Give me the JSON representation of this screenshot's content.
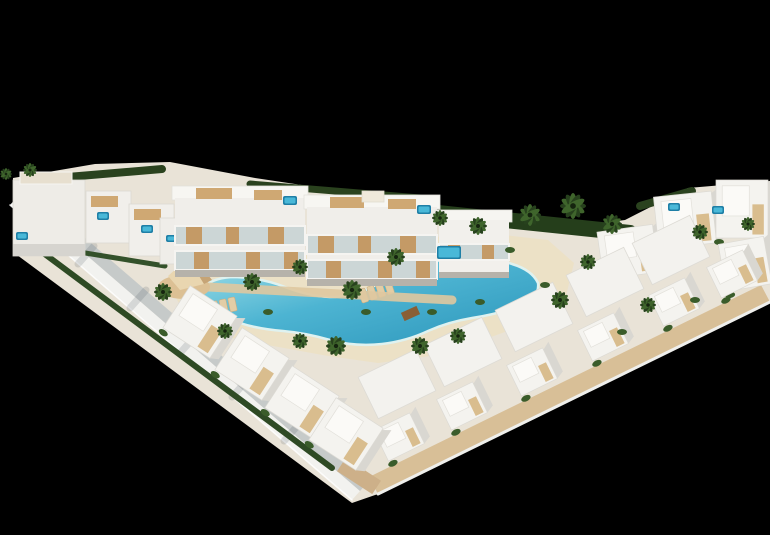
{
  "canvas": {
    "w": 770,
    "h": 535,
    "bg": "#000000"
  },
  "palette": {
    "background": "#000000",
    "building_white": "#f4f3ef",
    "building_shadow": "#c6cac9",
    "pool_light": "#9fdfe8",
    "pool_mid": "#4db4d2",
    "pool_deep": "#2b95ba",
    "sand": "#ece1c6",
    "wood": "#c49a66",
    "deck_wood": "#d8bf97",
    "hedge_green": "#253e1b",
    "palm_green": "#3f652c"
  },
  "shapes": [
    {
      "t": "poly",
      "n": "site-ground",
      "p": "13,178 95,164 170,162 255,178 335,190 425,202 490,217 565,228 625,220 688,188 770,181 770,302 378,494 352,503 13,252",
      "f": "#e9e3d7"
    },
    {
      "t": "poly",
      "n": "perimeter-wall-outer",
      "p": "10,205 352,500 360,491 18,196",
      "f": "#f2f2ef"
    },
    {
      "t": "poly",
      "n": "perimeter-wall-inner",
      "p": "18,196 360,491 368,482 26,187",
      "f": "#c6cac9"
    },
    {
      "t": "line",
      "n": "wall-edge-highlight",
      "x1": 10,
      "y1": 205,
      "x2": 352,
      "y2": 500,
      "f": "#ffffff",
      "wd": 1.5,
      "o": 0.85
    },
    {
      "t": "line",
      "n": "wall-shadow-streak",
      "x1": 78,
      "y1": 264,
      "x2": 94,
      "y2": 246,
      "f": "rgba(60,72,84,0.16)",
      "wd": 7
    },
    {
      "t": "line",
      "n": "wall-shadow-streak",
      "x1": 130,
      "y1": 308,
      "x2": 146,
      "y2": 290,
      "f": "rgba(60,72,84,0.16)",
      "wd": 7
    },
    {
      "t": "line",
      "n": "wall-shadow-streak",
      "x1": 181,
      "y1": 352,
      "x2": 197,
      "y2": 334,
      "f": "rgba(60,72,84,0.16)",
      "wd": 7
    },
    {
      "t": "line",
      "n": "wall-shadow-streak",
      "x1": 232,
      "y1": 397,
      "x2": 248,
      "y2": 379,
      "f": "rgba(60,72,84,0.16)",
      "wd": 7
    },
    {
      "t": "line",
      "n": "wall-shadow-streak",
      "x1": 284,
      "y1": 441,
      "x2": 300,
      "y2": 423,
      "f": "rgba(60,72,84,0.16)",
      "wd": 7
    },
    {
      "t": "poly",
      "n": "boardwalk-deck",
      "p": "770,302 378,494 369,477 761,285",
      "f": "#d8bf97"
    },
    {
      "t": "line",
      "n": "deck-edge-highlight",
      "x1": 770,
      "y1": 302,
      "x2": 378,
      "y2": 494,
      "f": "#efefec",
      "wd": 3
    },
    {
      "t": "poly",
      "n": "beach-sand",
      "p": "175,296 205,267 255,257 315,251 375,244 435,237 495,234 548,240 574,263 566,296 530,323 480,341 430,356 378,363 328,356 273,346 223,336 187,318",
      "f": "#ece1c6"
    },
    {
      "t": "line",
      "n": "hedge",
      "x1": 32,
      "y1": 180,
      "x2": 162,
      "y2": 169,
      "f": "#2a421e",
      "wd": 8
    },
    {
      "t": "line",
      "n": "hedge",
      "x1": 250,
      "y1": 184,
      "x2": 420,
      "y2": 198,
      "f": "#2a421e",
      "wd": 7
    },
    {
      "t": "line",
      "n": "hedge",
      "x1": 428,
      "y1": 212,
      "x2": 630,
      "y2": 233,
      "f": "#253e1b",
      "wd": 16
    },
    {
      "t": "line",
      "n": "hedge",
      "x1": 640,
      "y1": 206,
      "x2": 692,
      "y2": 191,
      "f": "#2a421e",
      "wd": 8
    },
    {
      "t": "line",
      "n": "hedge",
      "x1": 42,
      "y1": 252,
      "x2": 332,
      "y2": 468,
      "f": "#2e4a24",
      "wd": 6
    },
    {
      "t": "line",
      "n": "hedge",
      "x1": 30,
      "y1": 244,
      "x2": 165,
      "y2": 266,
      "f": "#33512a",
      "wd": 5
    },
    {
      "t": "path",
      "n": "lagoon-pool",
      "d": "M203,287 Q215,277 235,277 Q262,278 285,287 Q308,296 330,297 Q352,297 372,287 Q392,276 412,268 Q435,259 462,258 Q492,257 512,264 Q532,270 538,283 Q540,298 520,306 Q498,314 472,318 Q448,322 428,331 Q407,341 382,344 Q355,347 330,340 Q306,333 283,331 Q258,329 240,323 Q218,316 207,303 Q197,292 203,287 Z",
      "f": "url(#gPool)",
      "st": "#dff2f0",
      "sw": 2.5
    },
    {
      "t": "rect",
      "n": "wood-bridge",
      "x": 402,
      "y": 309,
      "w": 17,
      "h": 9,
      "r": -24,
      "f": "#8a5f35"
    },
    {
      "t": "lounger",
      "n": "sun-loungers",
      "x": 358,
      "y": 290,
      "r": -18,
      "c": 4
    },
    {
      "t": "lounger",
      "n": "sun-loungers",
      "x": 210,
      "y": 302,
      "r": -12,
      "c": 3
    },
    {
      "t": "line",
      "n": "promenade-path",
      "x1": 190,
      "y1": 286,
      "x2": 452,
      "y2": 300,
      "f": "#dfc8a0",
      "wd": 9,
      "o": 0.9
    },
    {
      "t": "ellipse",
      "n": "sand-dune",
      "cx": 184,
      "cy": 287,
      "rx": 26,
      "ry": 12,
      "f": "#dcc094"
    },
    {
      "t": "poly",
      "n": "shade-sail",
      "p": "168,276 188,258 204,284 180,290",
      "f": "#e9d6b0"
    },
    {
      "t": "poly",
      "n": "shade-sail",
      "p": "188,258 204,284 212,280 198,262",
      "f": "#c6a476"
    },
    {
      "t": "rect",
      "n": "townhouse-block",
      "x": 13,
      "y": 180,
      "w": 72,
      "h": 76,
      "f": "#eeece7",
      "st": "#dbd9d3",
      "sw": 0.8
    },
    {
      "t": "rect",
      "n": "townhouse-base-shadow",
      "x": 13,
      "y": 244,
      "w": 72,
      "h": 12,
      "f": "#d6d4cf"
    },
    {
      "t": "rect",
      "n": "roof-terrace",
      "x": 20,
      "y": 172,
      "w": 52,
      "h": 12,
      "f": "#e7dfcf",
      "st": "#f6f5f1",
      "sw": 1
    },
    {
      "t": "rect",
      "n": "townhouse",
      "x": 86,
      "y": 191,
      "w": 45,
      "h": 52,
      "f": "#f1efeb",
      "st": "#dbd9d3",
      "sw": 0.8
    },
    {
      "t": "rect",
      "n": "roof-deck-wood",
      "x": 91,
      "y": 196,
      "w": 27,
      "h": 11,
      "f": "#cfa873"
    },
    {
      "t": "rect",
      "n": "townhouse",
      "x": 129,
      "y": 204,
      "w": 45,
      "h": 52,
      "f": "#f1efeb",
      "st": "#dbd9d3",
      "sw": 0.8
    },
    {
      "t": "rect",
      "n": "roof-deck-wood",
      "x": 134,
      "y": 209,
      "w": 27,
      "h": 11,
      "f": "#cfa873"
    },
    {
      "t": "rect",
      "n": "townhouse",
      "x": 160,
      "y": 218,
      "w": 34,
      "h": 46,
      "f": "#efede9",
      "st": "#dbd9d3",
      "sw": 0.8
    },
    {
      "t": "spa",
      "n": "roof-spa",
      "x": 97,
      "y": 212,
      "w": 12,
      "h": 8
    },
    {
      "t": "spa",
      "n": "roof-spa",
      "x": 141,
      "y": 225,
      "w": 12,
      "h": 8
    },
    {
      "t": "spa",
      "n": "roof-spa",
      "x": 166,
      "y": 235,
      "w": 10,
      "h": 7
    },
    {
      "t": "spa",
      "n": "garden-spa",
      "x": 16,
      "y": 232,
      "w": 12,
      "h": 8
    },
    {
      "t": "rect",
      "n": "apartment-roof",
      "x": 172,
      "y": 186,
      "w": 136,
      "h": 14,
      "f": "#f7f6f2",
      "st": "#e3e1db",
      "sw": 0.8
    },
    {
      "t": "rect",
      "n": "apartment-body",
      "x": 175,
      "y": 198,
      "w": 130,
      "h": 74,
      "f": "#f0eeea"
    },
    {
      "t": "rect",
      "n": "balcony-band",
      "x": 175,
      "y": 226,
      "w": 130,
      "h": 19,
      "f": "#ccd6d6"
    },
    {
      "t": "rect",
      "n": "wood-panel",
      "x": 186,
      "y": 226,
      "w": 16,
      "h": 19,
      "f": "#c49a66"
    },
    {
      "t": "rect",
      "n": "wood-panel",
      "x": 226,
      "y": 226,
      "w": 13,
      "h": 19,
      "f": "#c49a66"
    },
    {
      "t": "rect",
      "n": "wood-panel",
      "x": 268,
      "y": 226,
      "w": 16,
      "h": 19,
      "f": "#c49a66"
    },
    {
      "t": "rect",
      "n": "balcony-frame",
      "x": 175,
      "y": 226,
      "w": 130,
      "h": 19,
      "f": "none",
      "st": "#f5f4f1",
      "sw": 2
    },
    {
      "t": "rect",
      "n": "balcony-band",
      "x": 175,
      "y": 251,
      "w": 130,
      "h": 19,
      "f": "#ccd6d6"
    },
    {
      "t": "rect",
      "n": "wood-panel",
      "x": 194,
      "y": 251,
      "w": 15,
      "h": 19,
      "f": "#c49a66"
    },
    {
      "t": "rect",
      "n": "wood-panel",
      "x": 246,
      "y": 251,
      "w": 14,
      "h": 19,
      "f": "#c49a66"
    },
    {
      "t": "rect",
      "n": "wood-panel",
      "x": 284,
      "y": 251,
      "w": 14,
      "h": 19,
      "f": "#c49a66"
    },
    {
      "t": "rect",
      "n": "balcony-frame",
      "x": 175,
      "y": 251,
      "w": 130,
      "h": 19,
      "f": "none",
      "st": "#f5f4f1",
      "sw": 2
    },
    {
      "t": "rect",
      "n": "apartment-base-shadow",
      "x": 175,
      "y": 270,
      "w": 130,
      "h": 7,
      "f": "#b6b2aa"
    },
    {
      "t": "rect",
      "n": "roof-deck-wood",
      "x": 196,
      "y": 188,
      "w": 36,
      "h": 11,
      "f": "#cfa873"
    },
    {
      "t": "rect",
      "n": "roof-deck-wood",
      "x": 254,
      "y": 190,
      "w": 28,
      "h": 10,
      "f": "#cfa873"
    },
    {
      "t": "spa",
      "n": "roof-spa",
      "x": 283,
      "y": 196,
      "w": 14,
      "h": 9
    },
    {
      "t": "rect",
      "n": "apartment-roof",
      "x": 304,
      "y": 195,
      "w": 136,
      "h": 14,
      "f": "#f7f6f2",
      "st": "#e3e1db",
      "sw": 0.8
    },
    {
      "t": "rect",
      "n": "apartment-body",
      "x": 307,
      "y": 207,
      "w": 130,
      "h": 74,
      "f": "#f0eeea"
    },
    {
      "t": "rect",
      "n": "balcony-band",
      "x": 307,
      "y": 235,
      "w": 130,
      "h": 19,
      "f": "#ccd6d6"
    },
    {
      "t": "rect",
      "n": "wood-panel",
      "x": 318,
      "y": 235,
      "w": 16,
      "h": 19,
      "f": "#c49a66"
    },
    {
      "t": "rect",
      "n": "wood-panel",
      "x": 358,
      "y": 235,
      "w": 13,
      "h": 19,
      "f": "#c49a66"
    },
    {
      "t": "rect",
      "n": "wood-panel",
      "x": 400,
      "y": 235,
      "w": 16,
      "h": 19,
      "f": "#c49a66"
    },
    {
      "t": "rect",
      "n": "balcony-frame",
      "x": 307,
      "y": 235,
      "w": 130,
      "h": 19,
      "f": "none",
      "st": "#f5f4f1",
      "sw": 2
    },
    {
      "t": "rect",
      "n": "balcony-band",
      "x": 307,
      "y": 260,
      "w": 130,
      "h": 19,
      "f": "#ccd6d6"
    },
    {
      "t": "rect",
      "n": "wood-panel",
      "x": 326,
      "y": 260,
      "w": 15,
      "h": 19,
      "f": "#c49a66"
    },
    {
      "t": "rect",
      "n": "wood-panel",
      "x": 378,
      "y": 260,
      "w": 14,
      "h": 19,
      "f": "#c49a66"
    },
    {
      "t": "rect",
      "n": "wood-panel",
      "x": 416,
      "y": 260,
      "w": 14,
      "h": 19,
      "f": "#c49a66"
    },
    {
      "t": "rect",
      "n": "balcony-frame",
      "x": 307,
      "y": 260,
      "w": 130,
      "h": 19,
      "f": "none",
      "st": "#f5f4f1",
      "sw": 2
    },
    {
      "t": "rect",
      "n": "apartment-base-shadow",
      "x": 307,
      "y": 279,
      "w": 130,
      "h": 7,
      "f": "#b6b2aa"
    },
    {
      "t": "rect",
      "n": "roof-deck-wood",
      "x": 330,
      "y": 197,
      "w": 34,
      "h": 11,
      "f": "#cfa873"
    },
    {
      "t": "rect",
      "n": "roof-deck-wood",
      "x": 388,
      "y": 199,
      "w": 28,
      "h": 10,
      "f": "#cfa873"
    },
    {
      "t": "rect",
      "n": "stair-bulkhead",
      "x": 362,
      "y": 191,
      "w": 22,
      "h": 11,
      "f": "#efe9db",
      "st": "#e0dcd0",
      "sw": 0.8
    },
    {
      "t": "spa",
      "n": "roof-spa",
      "x": 417,
      "y": 205,
      "w": 14,
      "h": 9
    },
    {
      "t": "rect",
      "n": "apartment-roof",
      "x": 436,
      "y": 210,
      "w": 76,
      "h": 12,
      "f": "#f6f5f1",
      "st": "#e3e1db",
      "sw": 0.8
    },
    {
      "t": "rect",
      "n": "apartment-body",
      "x": 439,
      "y": 220,
      "w": 70,
      "h": 56,
      "f": "#f2f0ec"
    },
    {
      "t": "rect",
      "n": "balcony-band",
      "x": 439,
      "y": 244,
      "w": 70,
      "h": 16,
      "f": "#ccd6d6"
    },
    {
      "t": "rect",
      "n": "wood-panel",
      "x": 448,
      "y": 244,
      "w": 12,
      "h": 16,
      "f": "#c49a66"
    },
    {
      "t": "rect",
      "n": "wood-panel",
      "x": 482,
      "y": 244,
      "w": 12,
      "h": 16,
      "f": "#c49a66"
    },
    {
      "t": "rect",
      "n": "balcony-frame",
      "x": 439,
      "y": 244,
      "w": 70,
      "h": 16,
      "f": "none",
      "st": "#f5f4f1",
      "sw": 2
    },
    {
      "t": "rect",
      "n": "apartment-base-shadow",
      "x": 439,
      "y": 272,
      "w": 70,
      "h": 6,
      "f": "#b6b2aa"
    },
    {
      "t": "spa",
      "n": "terrace-pool",
      "x": 437,
      "y": 246,
      "w": 24,
      "h": 13
    },
    {
      "t": "villa",
      "n": "villa",
      "x": 600,
      "y": 228,
      "w": 56,
      "h": 48,
      "r": -8
    },
    {
      "t": "villa",
      "n": "villa",
      "x": 656,
      "y": 194,
      "w": 58,
      "h": 52,
      "r": -6
    },
    {
      "t": "villa",
      "n": "villa",
      "x": 716,
      "y": 180,
      "w": 52,
      "h": 58,
      "r": 0
    },
    {
      "t": "villa",
      "n": "villa",
      "x": 722,
      "y": 240,
      "w": 46,
      "h": 48,
      "r": -10
    },
    {
      "t": "spa",
      "n": "roof-spa",
      "x": 668,
      "y": 203,
      "w": 12,
      "h": 8
    },
    {
      "t": "spa",
      "n": "roof-spa",
      "x": 712,
      "y": 206,
      "w": 12,
      "h": 8
    },
    {
      "t": "rect",
      "n": "villa-roof",
      "x": 365,
      "y": 361,
      "w": 64,
      "h": 46,
      "r": -26,
      "f": "#f3f2ee",
      "st": "#dddbd5",
      "sw": 0.8
    },
    {
      "t": "rect",
      "n": "villa-roof",
      "x": 431,
      "y": 329,
      "w": 64,
      "h": 46,
      "r": -26,
      "f": "#f3f2ee",
      "st": "#dddbd5",
      "sw": 0.8
    },
    {
      "t": "rect",
      "n": "villa-roof",
      "x": 502,
      "y": 294,
      "w": 64,
      "h": 46,
      "r": -26,
      "f": "#f3f2ee",
      "st": "#dddbd5",
      "sw": 0.8
    },
    {
      "t": "rect",
      "n": "villa-roof",
      "x": 573,
      "y": 259,
      "w": 64,
      "h": 46,
      "r": -26,
      "f": "#f3f2ee",
      "st": "#dddbd5",
      "sw": 0.8
    },
    {
      "t": "rect",
      "n": "villa-roof",
      "x": 639,
      "y": 227,
      "w": 64,
      "h": 46,
      "r": -26,
      "f": "#f3f2ee",
      "st": "#dddbd5",
      "sw": 0.8
    },
    {
      "t": "villa",
      "n": "villa",
      "x": 379,
      "y": 420,
      "w": 40,
      "h": 34,
      "r": -26
    },
    {
      "t": "villa",
      "n": "villa",
      "x": 442,
      "y": 389,
      "w": 40,
      "h": 34,
      "r": -26
    },
    {
      "t": "villa",
      "n": "villa",
      "x": 512,
      "y": 355,
      "w": 40,
      "h": 34,
      "r": -26
    },
    {
      "t": "villa",
      "n": "villa",
      "x": 583,
      "y": 320,
      "w": 40,
      "h": 34,
      "r": -26
    },
    {
      "t": "villa",
      "n": "villa",
      "x": 654,
      "y": 285,
      "w": 40,
      "h": 34,
      "r": -26
    },
    {
      "t": "villa",
      "n": "villa",
      "x": 712,
      "y": 257,
      "w": 40,
      "h": 34,
      "r": -26
    },
    {
      "t": "rect",
      "n": "entry-path",
      "x": 338,
      "y": 468,
      "w": 42,
      "h": 16,
      "r": 33,
      "f": "#cdb089"
    },
    {
      "t": "villa",
      "n": "villa",
      "x": 172,
      "y": 297,
      "w": 56,
      "h": 50,
      "r": 33
    },
    {
      "t": "villa",
      "n": "villa",
      "x": 224,
      "y": 339,
      "w": 56,
      "h": 50,
      "r": 33
    },
    {
      "t": "villa",
      "n": "villa",
      "x": 274,
      "y": 377,
      "w": 56,
      "h": 50,
      "r": 33
    },
    {
      "t": "villa",
      "n": "villa",
      "x": 318,
      "y": 409,
      "w": 56,
      "h": 50,
      "r": 33
    },
    {
      "t": "ellipse",
      "n": "shrub",
      "cx": 510,
      "cy": 250,
      "rx": 5,
      "ry": 3,
      "f": "#3a5c2a"
    },
    {
      "t": "ellipse",
      "n": "shrub",
      "cx": 545,
      "cy": 285,
      "rx": 5,
      "ry": 3,
      "f": "#3a5c2a"
    },
    {
      "t": "ellipse",
      "n": "shrub",
      "cx": 480,
      "cy": 302,
      "rx": 5,
      "ry": 3,
      "f": "#3a5c2a"
    },
    {
      "t": "ellipse",
      "n": "shrub",
      "cx": 432,
      "cy": 312,
      "rx": 5,
      "ry": 3,
      "f": "#3a5c2a"
    },
    {
      "t": "ellipse",
      "n": "shrub",
      "cx": 366,
      "cy": 312,
      "rx": 5,
      "ry": 3,
      "f": "#3a5c2a"
    },
    {
      "t": "ellipse",
      "n": "shrub",
      "cx": 268,
      "cy": 312,
      "rx": 5,
      "ry": 3,
      "f": "#3a5c2a"
    },
    {
      "t": "ellipse",
      "n": "shrub",
      "cx": 622,
      "cy": 332,
      "rx": 5,
      "ry": 3,
      "f": "#3a5c2a"
    },
    {
      "t": "ellipse",
      "n": "shrub",
      "cx": 695,
      "cy": 300,
      "rx": 5,
      "ry": 3,
      "f": "#3a5c2a"
    },
    {
      "t": "palm",
      "n": "palm-tree",
      "x": 6,
      "y": 174,
      "rr": 6
    },
    {
      "t": "palm",
      "n": "palm-tree",
      "x": 30,
      "y": 170,
      "rr": 7
    },
    {
      "t": "palm",
      "n": "palm-tree",
      "x": 440,
      "y": 218,
      "rr": 8
    },
    {
      "t": "palm",
      "n": "palm-tree",
      "x": 478,
      "y": 226,
      "rr": 9
    },
    {
      "t": "palm",
      "n": "palm-tree",
      "x": 530,
      "y": 215,
      "rr": 11
    },
    {
      "t": "palm",
      "n": "palm-tree",
      "x": 573,
      "y": 206,
      "rr": 13
    },
    {
      "t": "palm",
      "n": "palm-tree",
      "x": 612,
      "y": 224,
      "rr": 10
    },
    {
      "t": "palm",
      "n": "palm-tree",
      "x": 252,
      "y": 282,
      "rr": 9
    },
    {
      "t": "palm",
      "n": "palm-tree",
      "x": 300,
      "y": 267,
      "rr": 8
    },
    {
      "t": "palm",
      "n": "palm-tree",
      "x": 352,
      "y": 290,
      "rr": 10
    },
    {
      "t": "palm",
      "n": "palm-tree",
      "x": 396,
      "y": 257,
      "rr": 9
    },
    {
      "t": "palm",
      "n": "palm-tree",
      "x": 225,
      "y": 331,
      "rr": 8
    },
    {
      "t": "palm",
      "n": "palm-tree",
      "x": 300,
      "y": 341,
      "rr": 8
    },
    {
      "t": "palm",
      "n": "palm-tree",
      "x": 336,
      "y": 346,
      "rr": 10
    },
    {
      "t": "palm",
      "n": "palm-tree",
      "x": 420,
      "y": 346,
      "rr": 9
    },
    {
      "t": "palm",
      "n": "palm-tree",
      "x": 458,
      "y": 336,
      "rr": 8
    },
    {
      "t": "palm",
      "n": "palm-tree",
      "x": 163,
      "y": 292,
      "rr": 9
    },
    {
      "t": "palm",
      "n": "palm-tree",
      "x": 560,
      "y": 300,
      "rr": 9
    },
    {
      "t": "palm",
      "n": "palm-tree",
      "x": 588,
      "y": 262,
      "rr": 8
    },
    {
      "t": "palm",
      "n": "palm-tree",
      "x": 648,
      "y": 305,
      "rr": 8
    },
    {
      "t": "palm",
      "n": "palm-tree",
      "x": 700,
      "y": 232,
      "rr": 8
    },
    {
      "t": "palm",
      "n": "palm-tree",
      "x": 748,
      "y": 224,
      "rr": 7
    }
  ]
}
